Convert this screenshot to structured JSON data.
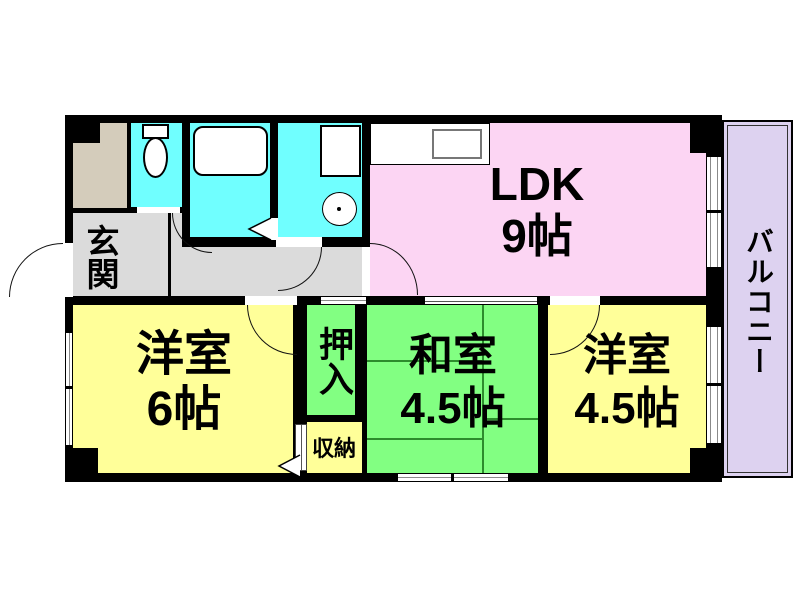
{
  "plan": {
    "rooms": {
      "ldk": {
        "label": "LDK",
        "size": "9帖"
      },
      "western_6": {
        "label": "洋室",
        "size": "6帖"
      },
      "japanese_4_5": {
        "label": "和室",
        "size": "4.5帖"
      },
      "western_4_5": {
        "label": "洋室",
        "size": "4.5帖"
      },
      "entrance": {
        "label": "玄関"
      },
      "closet": {
        "label": "押入"
      },
      "storage": {
        "label": "収納"
      },
      "balcony": {
        "label": "バルコニー"
      }
    },
    "colors": {
      "wall": "#000000",
      "ldk_fill": "#FCD5F3",
      "western_fill": "#FFFF99",
      "japanese_fill": "#82FF82",
      "wet_area_fill": "#70FFFF",
      "hallway_fill": "#DBDBDB",
      "shoe_cabinet_fill": "#D4CCBB",
      "balcony_fill": "#DDD2F0"
    },
    "fixtures": {
      "toilet": "toilet",
      "bathtub": "bathtub",
      "washing_machine": "washing machine",
      "wash_basin": "wash basin",
      "kitchen_counter": "kitchen counter with sink"
    }
  }
}
